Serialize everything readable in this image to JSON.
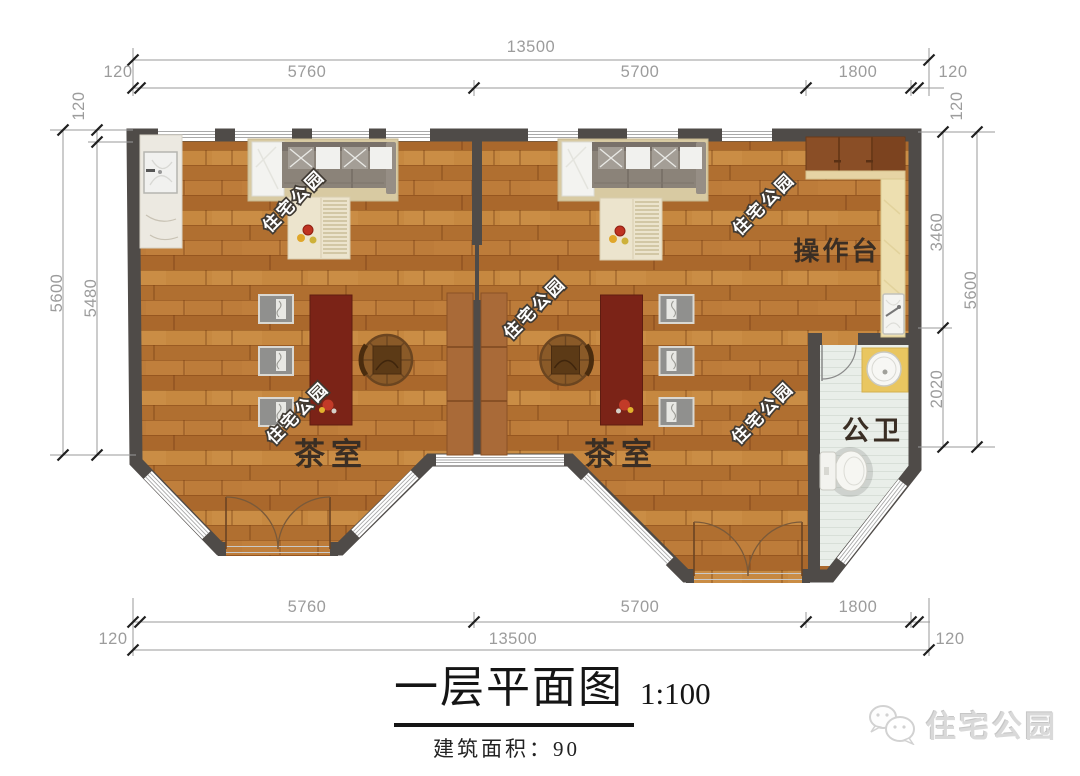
{
  "plan": {
    "watermark": "住宅公园",
    "rooms": {
      "tea_left": "茶室",
      "tea_right": "茶室",
      "counter": "操作台",
      "bathroom": "公卫"
    },
    "dims": {
      "top": {
        "overall": "13500",
        "segments": [
          "120",
          "5760",
          "5700",
          "1800",
          "120"
        ]
      },
      "bottom": {
        "overall": "13500",
        "segments": [
          "120",
          "5760",
          "5700",
          "1800",
          "120"
        ]
      },
      "left": {
        "outer": "5600",
        "inner": "5480",
        "wall_top": "120"
      },
      "right": {
        "outer": "5600",
        "upper": "3460",
        "lower": "2020",
        "wall_top": "120"
      }
    }
  },
  "title": {
    "text": "一层平面图",
    "scale": "1:100",
    "area": "建筑面积：90"
  },
  "logo": {
    "text": "住宅公园"
  },
  "colors": {
    "wall": "#4f4b48",
    "dim_text": "#9c9c9c",
    "dim_line": "#9a9a9a",
    "tick": "#1f1f1f",
    "room_label": "#3a2e24",
    "tea_table": "#7b2317",
    "watermark_fill": "#ffffff",
    "watermark_stroke": "#403a33",
    "title_text": "#151515",
    "logo_gray": "#d9d9d9",
    "bath_floor": "#e9eee9"
  }
}
